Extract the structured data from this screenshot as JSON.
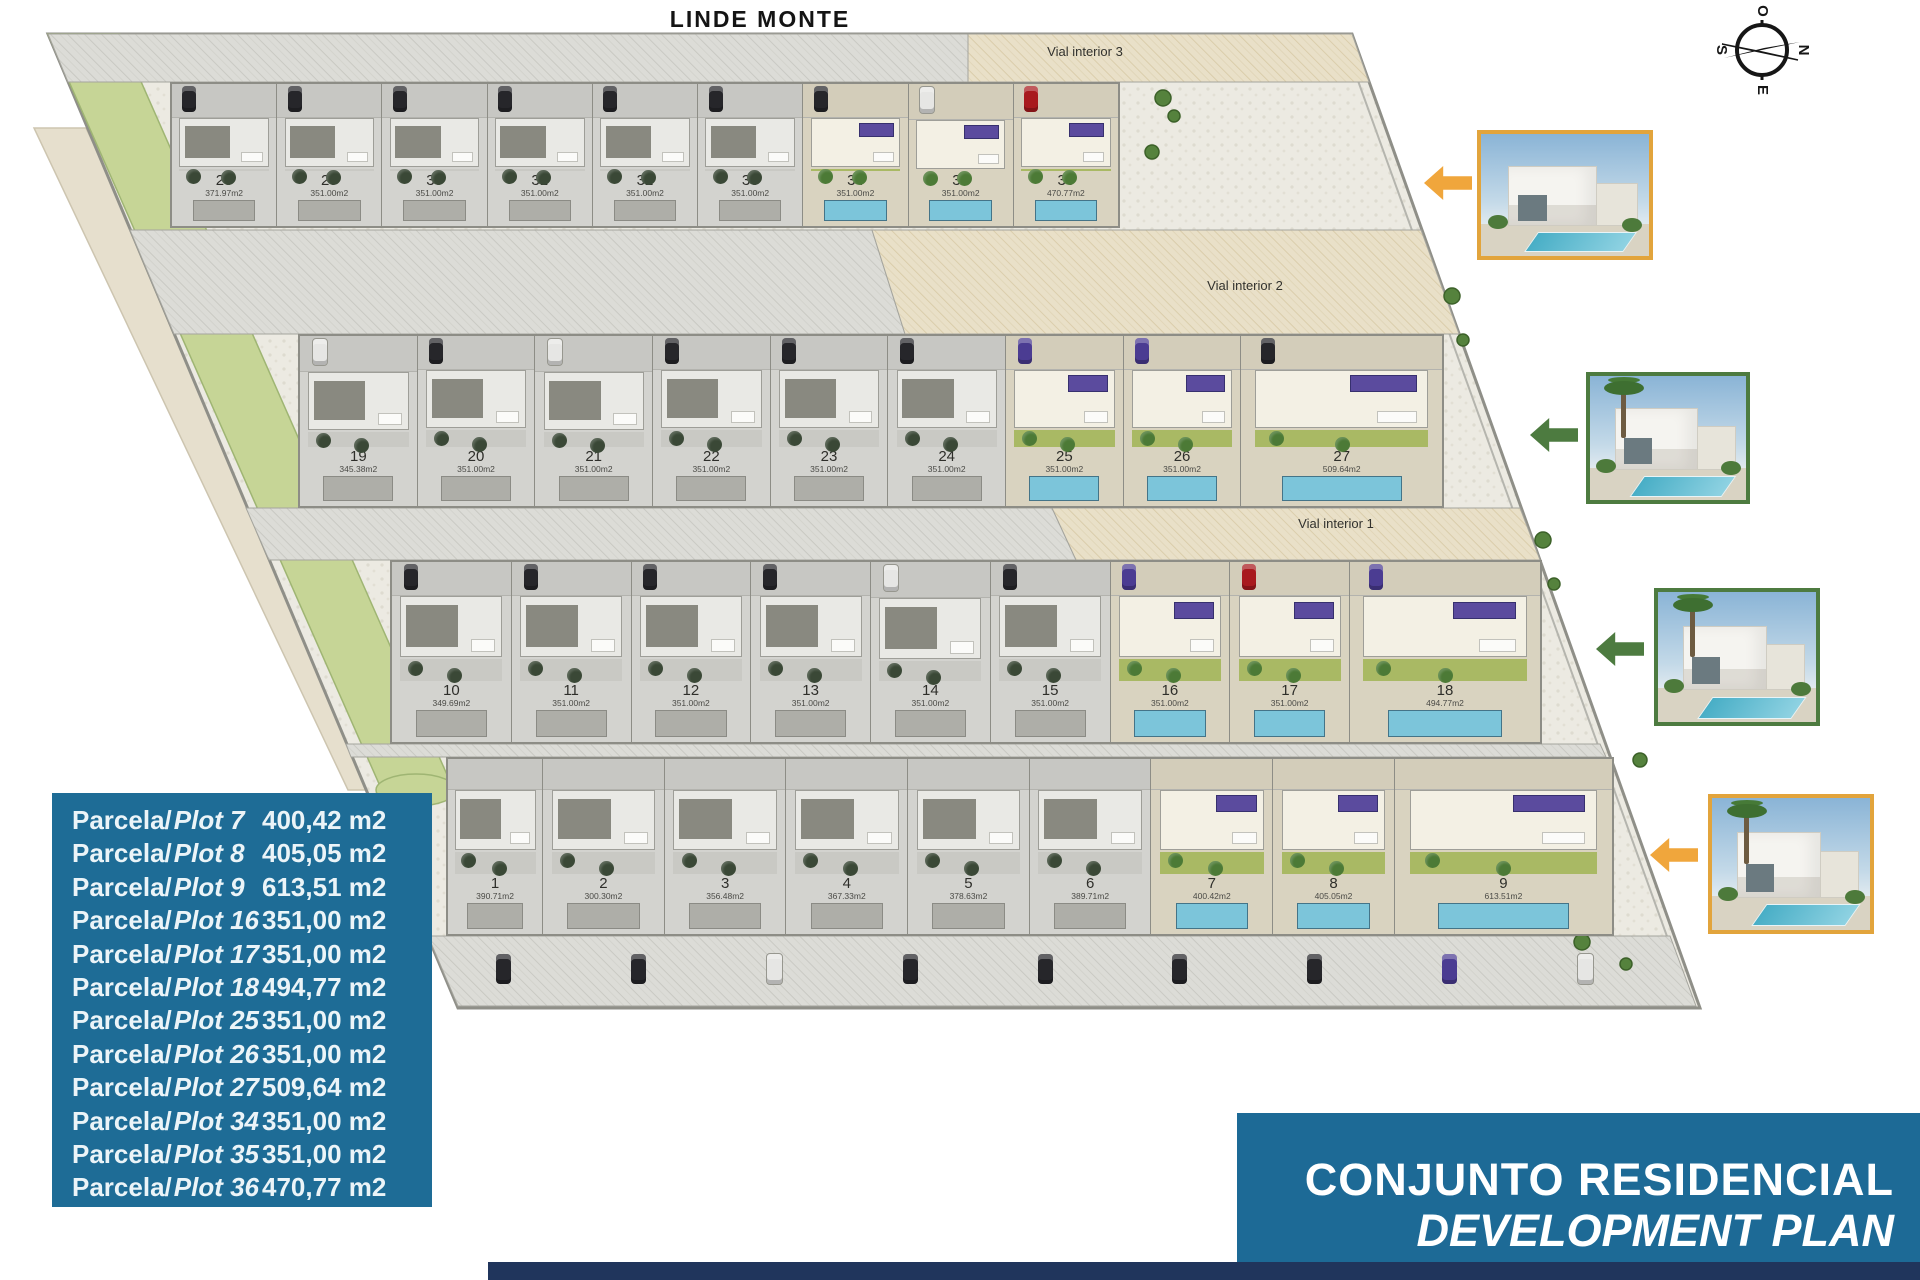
{
  "header": {
    "title": "LINDE MONTE"
  },
  "compass": {
    "top": "O",
    "right": "N",
    "bottom": "E",
    "left": "S"
  },
  "road_labels": [
    "Vial interior 3",
    "Vial interior 2",
    "Vial interior 1"
  ],
  "rows": [
    {
      "name": "row-1-plots-28-36",
      "plots": [
        {
          "num": "28",
          "area": "371.97m2",
          "available": false,
          "car": "black"
        },
        {
          "num": "29",
          "area": "351.00m2",
          "available": false,
          "car": "black"
        },
        {
          "num": "30",
          "area": "351.00m2",
          "available": false,
          "car": "black"
        },
        {
          "num": "31",
          "area": "351.00m2",
          "available": false,
          "car": "black"
        },
        {
          "num": "32",
          "area": "351.00m2",
          "available": false,
          "car": "black"
        },
        {
          "num": "33",
          "area": "351.00m2",
          "available": false,
          "car": "black"
        },
        {
          "num": "34",
          "area": "351.00m2",
          "available": true,
          "car": "black"
        },
        {
          "num": "35",
          "area": "351.00m2",
          "available": true,
          "car": "white"
        },
        {
          "num": "36",
          "area": "470.77m2",
          "available": true,
          "car": "red"
        }
      ]
    },
    {
      "name": "row-2-plots-19-27",
      "plots": [
        {
          "num": "19",
          "area": "345.38m2",
          "available": false,
          "car": "white"
        },
        {
          "num": "20",
          "area": "351.00m2",
          "available": false,
          "car": "black"
        },
        {
          "num": "21",
          "area": "351.00m2",
          "available": false,
          "car": "white"
        },
        {
          "num": "22",
          "area": "351.00m2",
          "available": false,
          "car": "black"
        },
        {
          "num": "23",
          "area": "351.00m2",
          "available": false,
          "car": "black"
        },
        {
          "num": "24",
          "area": "351.00m2",
          "available": false,
          "car": "black"
        },
        {
          "num": "25",
          "area": "351.00m2",
          "available": true,
          "car": "purple"
        },
        {
          "num": "26",
          "area": "351.00m2",
          "available": true,
          "car": "purple"
        },
        {
          "num": "27",
          "area": "509.64m2",
          "available": true,
          "car": "black"
        }
      ]
    },
    {
      "name": "row-3-plots-10-18",
      "plots": [
        {
          "num": "10",
          "area": "349.69m2",
          "available": false,
          "car": "black"
        },
        {
          "num": "11",
          "area": "351.00m2",
          "available": false,
          "car": "black"
        },
        {
          "num": "12",
          "area": "351.00m2",
          "available": false,
          "car": "black"
        },
        {
          "num": "13",
          "area": "351.00m2",
          "available": false,
          "car": "black"
        },
        {
          "num": "14",
          "area": "351.00m2",
          "available": false,
          "car": "white"
        },
        {
          "num": "15",
          "area": "351.00m2",
          "available": false,
          "car": "black"
        },
        {
          "num": "16",
          "area": "351.00m2",
          "available": true,
          "car": "purple"
        },
        {
          "num": "17",
          "area": "351.00m2",
          "available": true,
          "car": "red"
        },
        {
          "num": "18",
          "area": "494.77m2",
          "available": true,
          "car": "purple"
        }
      ]
    },
    {
      "name": "row-4-plots-1-9",
      "plots": [
        {
          "num": "1",
          "area": "390.71m2",
          "available": false,
          "car": null
        },
        {
          "num": "2",
          "area": "300.30m2",
          "available": false,
          "car": null
        },
        {
          "num": "3",
          "area": "356.48m2",
          "available": false,
          "car": null
        },
        {
          "num": "4",
          "area": "367.33m2",
          "available": false,
          "car": null
        },
        {
          "num": "5",
          "area": "378.63m2",
          "available": false,
          "car": null
        },
        {
          "num": "6",
          "area": "389.71m2",
          "available": false,
          "car": null
        },
        {
          "num": "7",
          "area": "400.42m2",
          "available": true,
          "car": null
        },
        {
          "num": "8",
          "area": "405.05m2",
          "available": true,
          "car": null
        },
        {
          "num": "9",
          "area": "613.51m2",
          "available": true,
          "car": null
        }
      ]
    }
  ],
  "bottom_road_cars": [
    "black",
    "black",
    "white",
    "black",
    "black",
    "black",
    "black",
    "purple",
    "white"
  ],
  "legend": {
    "prefix_es": "Parcela/",
    "prefix_en": "Plot",
    "items": [
      {
        "plot": "7",
        "area": "400,42 m2"
      },
      {
        "plot": "8",
        "area": "405,05 m2"
      },
      {
        "plot": "9",
        "area": "613,51 m2"
      },
      {
        "plot": "16",
        "area": "351,00 m2"
      },
      {
        "plot": "17",
        "area": "351,00 m2"
      },
      {
        "plot": "18",
        "area": "494,77 m2"
      },
      {
        "plot": "25",
        "area": "351,00 m2"
      },
      {
        "plot": "26",
        "area": "351,00 m2"
      },
      {
        "plot": "27",
        "area": "509,64 m2"
      },
      {
        "plot": "34",
        "area": "351,00 m2"
      },
      {
        "plot": "35",
        "area": "351,00 m2"
      },
      {
        "plot": "36",
        "area": "470,77 m2"
      }
    ]
  },
  "title_block": {
    "line1": "CONJUNTO RESIDENCIAL",
    "line2": "DEVELOPMENT PLAN"
  },
  "photos": [
    {
      "border": "#e2a43c",
      "arrow": "#f0a63c",
      "palm": false
    },
    {
      "border": "#4d7b40",
      "arrow": "#4d7b40",
      "palm": true
    },
    {
      "border": "#4d7b40",
      "arrow": "#4d7b40",
      "palm": true
    },
    {
      "border": "#e2a43c",
      "arrow": "#f0a63c",
      "palm": true
    }
  ],
  "colors": {
    "legend_bg": "#1e6c96",
    "title_bg": "#1d6a96",
    "footer_bg": "#20355c",
    "pool_blue": "#7cc5da",
    "garden_green": "#a9b964",
    "panel_purple": "#5b4b9e"
  }
}
